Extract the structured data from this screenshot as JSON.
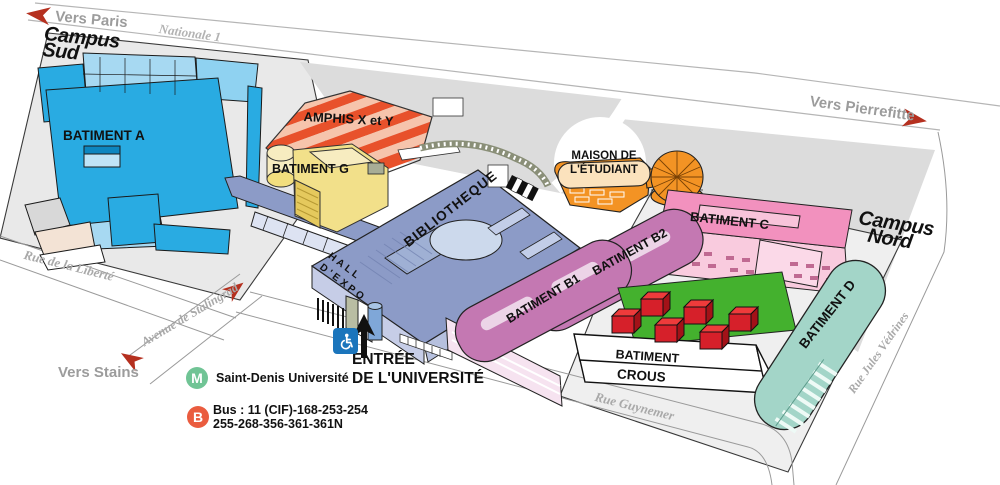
{
  "directions": {
    "paris": "Vers Paris",
    "pierrefitte": "Vers Pierrefitte",
    "stains": "Vers Stains"
  },
  "roads": {
    "nationale": "Nationale 1",
    "liberte": "Rue de la Liberté",
    "stalingrad": "Avenue de Stalingrad",
    "guynemer": "Rue Guynemer",
    "vedrines": "Rue Jules Védrines"
  },
  "campus": {
    "sud": {
      "line1": "Campus",
      "line2": "Sud"
    },
    "nord": {
      "line1": "Campus",
      "line2": "Nord"
    }
  },
  "buildings": {
    "a": "BATIMENT A",
    "g": "BATIMENT G",
    "amphis": "AMPHIS X et Y",
    "bibliotheque": "BIBLIOTHEQUE",
    "hall_expo": {
      "line1": "HALL",
      "line2": "D'EXPO"
    },
    "maison": {
      "line1": "MAISON DE",
      "line2": "L'ÉTUDIANT"
    },
    "b1": "BATIMENT B1",
    "b2": "BATIMENT B2",
    "c": "BATIMENT C",
    "d": "BATIMENT D",
    "crous": {
      "line1": "BATIMENT",
      "line2": "CROUS"
    }
  },
  "entrance": {
    "line1": "ENTRÉE",
    "line2": "DE L'UNIVERSITÉ"
  },
  "legend": {
    "metro_symbol": "M",
    "metro_label": "Saint-Denis Université",
    "bus_symbol": "B",
    "bus_line1": "Bus : 11 (CIF)-168-253-254",
    "bus_line2": "255-268-356-361-361N"
  },
  "colors": {
    "building_a_blue": "#29abe2",
    "building_g_yellow": "#f2de7e",
    "amphi_red": "#e8512b",
    "library_periwinkle": "#8c9bc7",
    "b_buildings_mauve": "#c478b2",
    "building_c_pink": "#f291be",
    "maison_orange": "#f39324",
    "building_d_teal": "#a3d5c8",
    "crous_red": "#d6202a",
    "field_green": "#44b12e",
    "metro_green": "#70c495",
    "bus_orange": "#ea5c3f",
    "accessibility_blue": "#1b75bc",
    "arrow_red": "#b5301f"
  }
}
